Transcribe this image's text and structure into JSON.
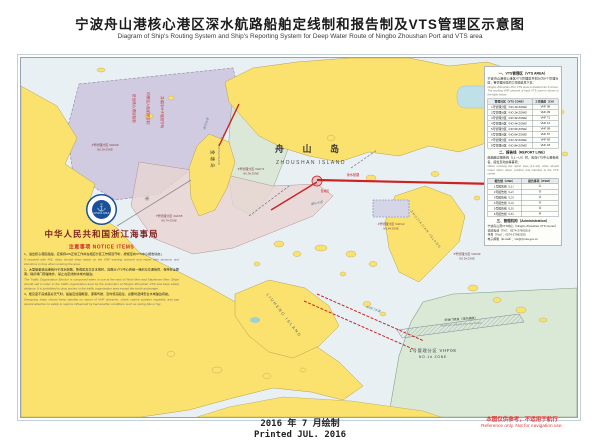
{
  "page": {
    "title_cn": "宁波舟山港核心港区深水航路船舶定线制和报告制及VTS管理区示意图",
    "title_en": "Diagram of Ship's Routing System and Ship's Reporting System for Deep Water Route of Ningbo Zhoushan Port and VTS area",
    "printed_cn": "2016 年 7 月绘制",
    "printed_en": "Printed JUL. 2016",
    "disclaimer_cn": "本图仅供参考，不适用于航行",
    "disclaimer_en": "Reference only. Not for navigation use."
  },
  "colors": {
    "sea": "#e8f0f4",
    "land": "#fbe26e",
    "zone_purple": "#c9c2dc",
    "zone_green": "#d7e6d0",
    "zone_pink": "#e8d4d2",
    "route_red": "#cc2222",
    "msa_blue": "#1a4f9c",
    "accent_red": "#cf2b2b"
  },
  "map": {
    "islands": {
      "zhoushan_cn": "舟  山  岛",
      "zhoushan_en": "ZHOUSHAN ISLAND",
      "jintang_cn": "金塘岛",
      "jintang_en": "JINTANG ISLAND",
      "liuheng_en": "LIUHENG ISLAND",
      "zhujiajian_en": "ZHUJIAJIAN ISLAND"
    },
    "zones": [
      {
        "cn": "1号管理分区 VHF08",
        "en": "NO.1# ZONE"
      },
      {
        "cn": "2号管理分区 VHF09",
        "en": "NO.2# ZONE"
      },
      {
        "cn": "3号管理分区 VHF71",
        "en": "NO.3# ZONE"
      },
      {
        "cn": "4号管理分区 VHF12",
        "en": "NO.4# ZONE"
      },
      {
        "cn": "5号管理分区 VHF09",
        "en": "NO.5# ZONE"
      },
      {
        "cn": "7号管理分区 VHF65",
        "en": "NO.7# ZONE"
      }
    ],
    "overprint": [
      "进出核心港区船舶",
      "均需加入船舶报告制",
      "并保持VHF值班守听"
    ],
    "waterways": [
      "册子水道",
      "螺头水道",
      "虾峙门水道"
    ],
    "fairway_cn": "虾峙门航道（双向通航）",
    "fairway_en": "Xiazhimen Channel (Two-way Route)",
    "route_label": "深水航路",
    "precaution_label": "警戒区"
  },
  "notice": {
    "authority": "中华人民共和国浙江海事局",
    "heading": "注意事项 NOTICE ITEMS",
    "emblem_text": "CHINA MSA",
    "items": [
      "1、进出核心港区船舶，应保持AIS正常工作并在相应分区工作频道守听，按规定向VTS中心报告动态；",
      "If required with AIS, ships should keep watch on the VHF working channel and report their dynamic and intentions in time when entering the area.",
      "2、大型船舶进出港航行于深水航路、警戒区及交叉水域时，应服从VTS中心的统一组织与交通指挥，保持安全距离；除虾峙门南锚地外，禁止在定线制水域内锚泊；",
      "The Traffic Organization Service is composed when in use at the east of Worli Men and Xiazhimen Men. Ships should sail in order in the traffic organization area by the instruction of Ningbo Zhoushan VTS and keep safety distance. It is prohibited to drop anchor in the traffic organization area except the south anchorage.",
      "3、能见度不良或恶劣天气时，船舶应加强瞭望、谨慎驾驶，及时核实船位，必要时选择安全水域锚泊待航。",
      "Sea-going ships should keep standby on report of VHF channels, check marine position regularly, and pay special attention to safety in regions influenced by bad weather conditions such as spring tide or fog."
    ]
  },
  "panel": {
    "sec1": {
      "title": "一、VTS管理区（VTS AREA）",
      "cn": "宁波舟山港核心港区VTS管理区共划分为8个管理分区，各管理分区的工作频道见下表：",
      "en": "Ningbo Zhoushan Port VTS area is divided into 8 zones. The working VHF channel of each VTS zone is shown in the table below.",
      "table": {
        "h1": "管理分区（VTS ZONE）",
        "h2": "工作频道（CH）",
        "rows": [
          [
            "1号管理分区（NO.1# ZONE）",
            "VHF 08"
          ],
          [
            "2号管理分区（NO.2# ZONE）",
            "VHF 09"
          ],
          [
            "3号管理分区（NO.3# ZONE）",
            "VHF 71"
          ],
          [
            "4号管理分区（NO.4# ZONE）",
            "VHF 12"
          ],
          [
            "5号管理分区（NO.5# ZONE）",
            "VHF 09"
          ],
          [
            "6号管理分区（NO.6# ZONE）",
            "VHF 67"
          ],
          [
            "7号管理分区（NO.7# ZONE）",
            "VHF 65"
          ],
          [
            "8号管理分区（NO.8# ZONE）",
            "VHF 18"
          ]
        ]
      }
    },
    "sec2": {
      "title": "二、报告线（REPORT LINE）",
      "cn": "船舶越过报告线（L1—L6）时，应向VTS中心报告船名、船位及动态等事项：",
      "en": "When crossing the report lines (L1–L6), ships should report ship's name, position and intention to the VTS center.",
      "table": {
        "h1": "报告线（LINE）",
        "h2": "报告事项（ITEM）",
        "rows": [
          [
            "1号报告线（L1）",
            "①"
          ],
          [
            "2号报告线（L2）",
            "②"
          ],
          [
            "3号报告线（L3）",
            "③"
          ],
          [
            "4号报告线（L4）",
            "④"
          ],
          [
            "5号报告线（L5）",
            "⑤"
          ],
          [
            "6号报告线（L6）",
            "⑥"
          ]
        ]
      }
    },
    "sec3": {
      "title": "三、管理机构（Administration）",
      "lines": [
        "宁波舟山港VTS中心（Ningbo Zhoushan VTS Center）",
        "值班电话（Tel）：0574-27682516",
        "传真（Fax）：0574-27682520",
        "电子邮箱（E-mail）：vts@zjmsa.gov.cn"
      ]
    }
  }
}
